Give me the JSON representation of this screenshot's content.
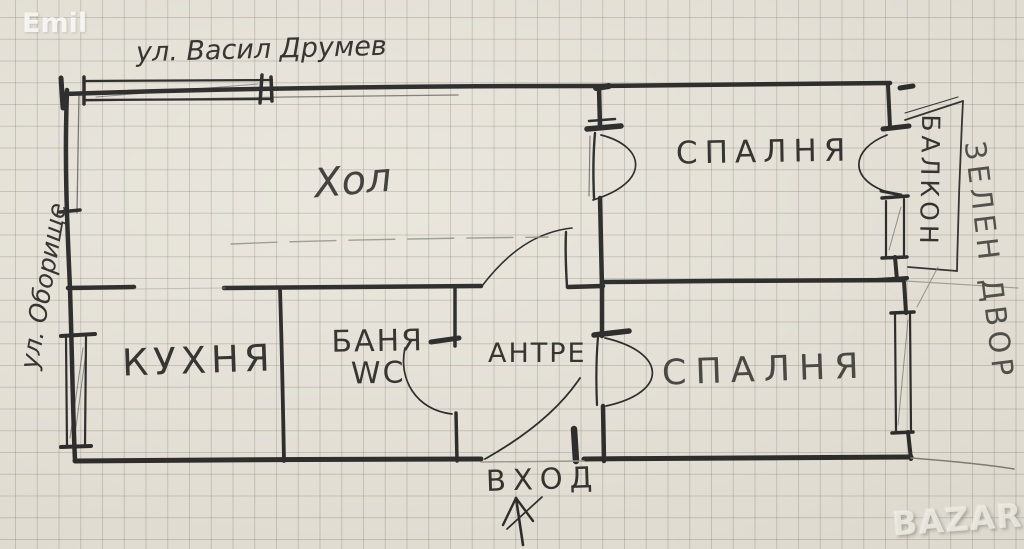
{
  "watermarks": {
    "photo_credit": "Emil",
    "site_logo": "BAZAR"
  },
  "plan": {
    "streets": {
      "top": "ул. Васил Друмев",
      "left": "ул. Оборище"
    },
    "rooms": {
      "living_room": "Хол",
      "bedroom_top": "СПАЛНЯ",
      "bedroom_bottom": "СПАЛНЯ",
      "kitchen": "КУХНЯ",
      "bathroom_line1": "БАНЯ",
      "bathroom_line2": "WC",
      "hallway": "АНТРЕ",
      "balcony": "БАЛКОН",
      "green_yard": "ЗЕЛЕН ДВОР",
      "entrance": "ВХОД"
    }
  },
  "colors": {
    "paper": "#e8e4da",
    "grid": "#7c796d",
    "ink": "#1b1b1b",
    "pencil": "#8a877b"
  }
}
